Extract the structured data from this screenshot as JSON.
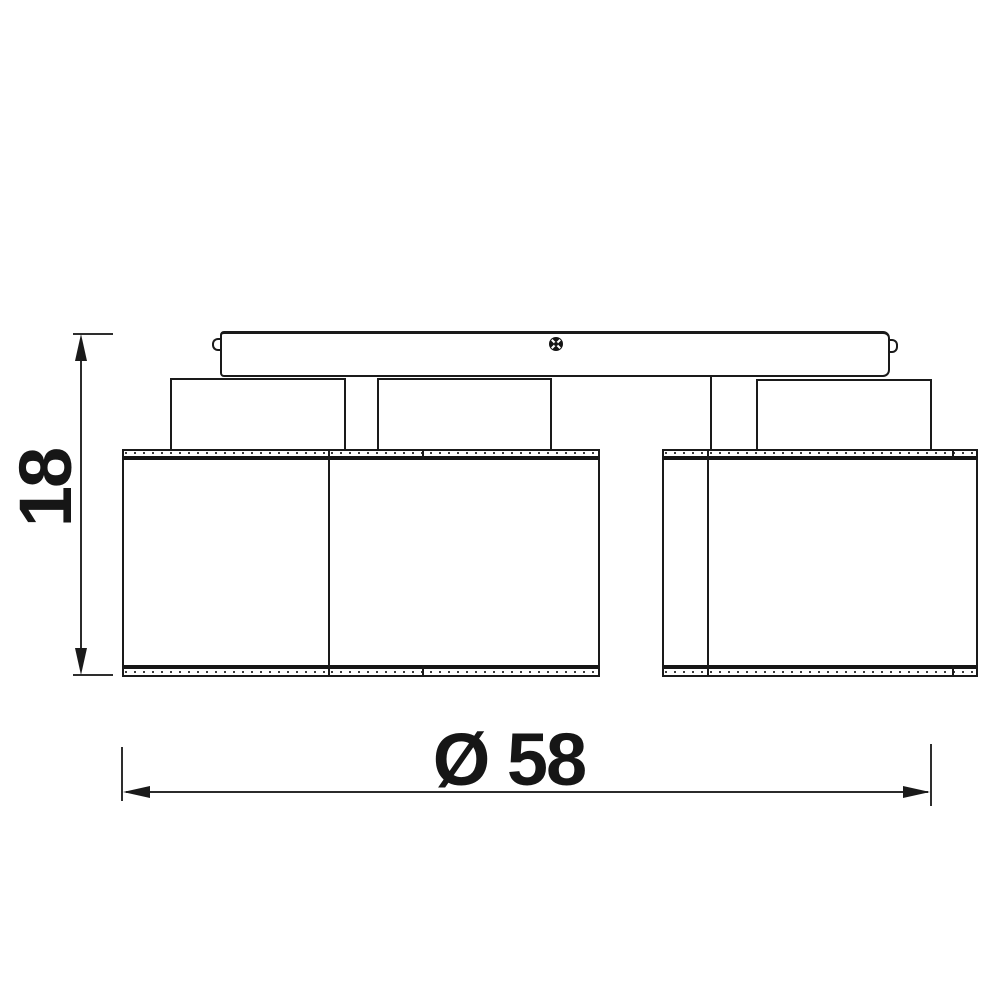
{
  "drawing": {
    "type": "technical-dimension-drawing",
    "background_color": "#ffffff",
    "line_color": "#1a1a1a",
    "dimensions": {
      "height": {
        "label": "18",
        "value": 18,
        "orientation": "vertical"
      },
      "width": {
        "label": "Ø 58",
        "value": 58,
        "symbol": "diameter",
        "orientation": "horizontal"
      }
    }
  }
}
